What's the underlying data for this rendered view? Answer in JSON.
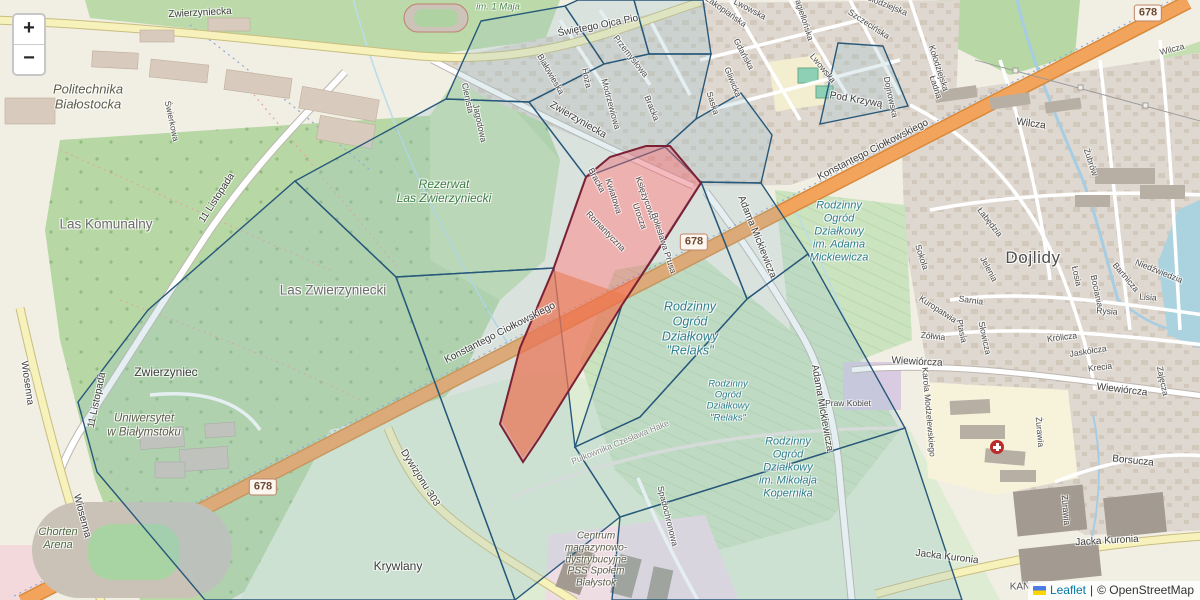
{
  "map": {
    "zoom_control": {
      "zoom_in": "+",
      "zoom_out": "−"
    },
    "attribution": {
      "flag_icon": "ukraine-flag-icon",
      "leaflet_label": "Leaflet",
      "separator": "|",
      "osm_label": "© OpenStreetMap"
    },
    "colors": {
      "overlay_stroke": "#27587a",
      "overlay_fill": "rgba(150,190,205,0.25)",
      "highlight_stroke": "#7a2136",
      "highlight_fill": "rgba(233,102,113,0.45)",
      "highlight_overlap_fill": "rgba(233,140,50,0.55)",
      "main_road": "#f2a35c",
      "leaflet_link": "#0078a8"
    },
    "road_badges": [
      {
        "text": "678",
        "x": 263,
        "y": 487
      },
      {
        "text": "678",
        "x": 694,
        "y": 242
      },
      {
        "text": "678",
        "x": 1148,
        "y": 13
      }
    ],
    "labels": [
      {
        "t": "Zwierzyniecka",
        "x": 200,
        "y": 13,
        "r": -3,
        "c": "road"
      },
      {
        "t": "Świętego Ojca Pio",
        "x": 598,
        "y": 26,
        "r": -11,
        "c": "road"
      },
      {
        "t": "Zwierzyniecka",
        "x": 578,
        "y": 120,
        "r": 30,
        "c": "road"
      },
      {
        "t": "Konstantego Ciołkowskiego",
        "x": 500,
        "y": 333,
        "r": -27,
        "c": "road"
      },
      {
        "t": "Konstantego Ciołkowskiego",
        "x": 873,
        "y": 150,
        "r": -27,
        "c": "road"
      },
      {
        "t": "11 Listopada",
        "x": 217,
        "y": 198,
        "r": -57,
        "c": "road"
      },
      {
        "t": "11 Listopada",
        "x": 97,
        "y": 400,
        "r": -78,
        "c": "road"
      },
      {
        "t": "Wiosenna",
        "x": 27,
        "y": 383,
        "r": 82,
        "c": "road"
      },
      {
        "t": "Wiosenna",
        "x": 82,
        "y": 516,
        "r": 75,
        "c": "road"
      },
      {
        "t": "Dywizjonu 303",
        "x": 420,
        "y": 478,
        "r": 58,
        "c": "road"
      },
      {
        "t": "Jacka Kuronia",
        "x": 947,
        "y": 557,
        "r": 7,
        "c": "road"
      },
      {
        "t": "Jacka Kuronia",
        "x": 1107,
        "y": 541,
        "r": -3,
        "c": "road"
      },
      {
        "t": "Adama Mickiewicza",
        "x": 757,
        "y": 237,
        "r": 68,
        "c": "road"
      },
      {
        "t": "Adama Mickiewicza",
        "x": 822,
        "y": 408,
        "r": 80,
        "c": "road"
      },
      {
        "t": "Pułkownika Czesława Hake",
        "x": 620,
        "y": 442,
        "r": -22,
        "c": "road-faint"
      },
      {
        "t": "Spadochronowa",
        "x": 668,
        "y": 516,
        "r": 76,
        "c": "road-sm"
      },
      {
        "t": "Wiewiórcza",
        "x": 917,
        "y": 362,
        "r": 3,
        "c": "road"
      },
      {
        "t": "Wiewiórcza",
        "x": 1122,
        "y": 390,
        "r": 7,
        "c": "road"
      },
      {
        "t": "Karola Modzelewskiego",
        "x": 929,
        "y": 412,
        "r": 85,
        "c": "road-sm"
      },
      {
        "t": "Praw Kobiet",
        "x": 848,
        "y": 403,
        "r": 0,
        "c": "road-sm"
      },
      {
        "t": "Borsucza",
        "x": 1133,
        "y": 461,
        "r": 6,
        "c": "road"
      },
      {
        "t": "Żurawia",
        "x": 1040,
        "y": 432,
        "r": 85,
        "c": "road-sm"
      },
      {
        "t": "Żurawia",
        "x": 1066,
        "y": 510,
        "r": 85,
        "c": "road-sm"
      },
      {
        "t": "Wilcza",
        "x": 1031,
        "y": 124,
        "r": 8,
        "c": "road"
      },
      {
        "t": "Wilcza",
        "x": 1172,
        "y": 49,
        "r": -15,
        "c": "road-sm"
      },
      {
        "t": "Białowieska",
        "x": 551,
        "y": 74,
        "r": 60,
        "c": "road-sm"
      },
      {
        "t": "Hoża",
        "x": 587,
        "y": 78,
        "r": 78,
        "c": "road-sm"
      },
      {
        "t": "Przemysłowa",
        "x": 631,
        "y": 56,
        "r": 52,
        "c": "road-sm"
      },
      {
        "t": "Modrzewiowa",
        "x": 611,
        "y": 104,
        "r": 75,
        "c": "road-sm"
      },
      {
        "t": "Bracka",
        "x": 652,
        "y": 108,
        "r": 68,
        "c": "road-sm"
      },
      {
        "t": "Bracka",
        "x": 597,
        "y": 180,
        "r": 62,
        "c": "road-sm"
      },
      {
        "t": "Saska",
        "x": 713,
        "y": 103,
        "r": 72,
        "c": "road-sm"
      },
      {
        "t": "Gliwicka",
        "x": 733,
        "y": 82,
        "r": 68,
        "c": "road-sm"
      },
      {
        "t": "Gdańska",
        "x": 744,
        "y": 54,
        "r": 62,
        "c": "road-sm"
      },
      {
        "t": "Zakopiańska",
        "x": 726,
        "y": 11,
        "r": 35,
        "c": "road-sm"
      },
      {
        "t": "Lwowska",
        "x": 750,
        "y": 9,
        "r": 28,
        "c": "road-sm"
      },
      {
        "t": "Lwowska",
        "x": 823,
        "y": 68,
        "r": 50,
        "c": "road-sm"
      },
      {
        "t": "Jagiellońska",
        "x": 804,
        "y": 18,
        "r": 72,
        "c": "road-sm"
      },
      {
        "t": "Szczecińska",
        "x": 869,
        "y": 24,
        "r": 33,
        "c": "road-sm"
      },
      {
        "t": "Kołodziejska",
        "x": 885,
        "y": 4,
        "r": 22,
        "c": "road-sm"
      },
      {
        "t": "Kołodziejska",
        "x": 939,
        "y": 68,
        "r": 72,
        "c": "road-sm"
      },
      {
        "t": "Pod Krzywą",
        "x": 856,
        "y": 100,
        "r": 10,
        "c": "road"
      },
      {
        "t": "Ładna",
        "x": 936,
        "y": 87,
        "r": 72,
        "c": "road-sm"
      },
      {
        "t": "Dojnowska",
        "x": 891,
        "y": 97,
        "r": 78,
        "c": "road-sm"
      },
      {
        "t": "Sokola",
        "x": 922,
        "y": 257,
        "r": 72,
        "c": "road-sm"
      },
      {
        "t": "Łabędzia",
        "x": 990,
        "y": 222,
        "r": 52,
        "c": "road-sm"
      },
      {
        "t": "Jelenia",
        "x": 989,
        "y": 269,
        "r": 62,
        "c": "road-sm"
      },
      {
        "t": "Sarnia",
        "x": 971,
        "y": 300,
        "r": 8,
        "c": "road-sm"
      },
      {
        "t": "Kuropatwia",
        "x": 938,
        "y": 309,
        "r": 33,
        "c": "road-sm"
      },
      {
        "t": "Żółwia",
        "x": 933,
        "y": 336,
        "r": 6,
        "c": "road-sm"
      },
      {
        "t": "Ptasia",
        "x": 962,
        "y": 331,
        "r": 78,
        "c": "road-sm"
      },
      {
        "t": "Słowicza",
        "x": 985,
        "y": 338,
        "r": 78,
        "c": "road-sm"
      },
      {
        "t": "Królicza",
        "x": 1062,
        "y": 337,
        "r": -7,
        "c": "road-sm"
      },
      {
        "t": "Jaskółcza",
        "x": 1088,
        "y": 351,
        "r": -9,
        "c": "road-sm"
      },
      {
        "t": "Krecia",
        "x": 1100,
        "y": 367,
        "r": -7,
        "c": "road-sm"
      },
      {
        "t": "Zajęcza",
        "x": 1163,
        "y": 381,
        "r": 78,
        "c": "road-sm"
      },
      {
        "t": "Niedźwiedzia",
        "x": 1159,
        "y": 271,
        "r": 22,
        "c": "road-sm"
      },
      {
        "t": "Bartnicza",
        "x": 1126,
        "y": 277,
        "r": 50,
        "c": "road-sm"
      },
      {
        "t": "Łosia",
        "x": 1077,
        "y": 276,
        "r": 78,
        "c": "road-sm"
      },
      {
        "t": "Bociania",
        "x": 1097,
        "y": 291,
        "r": 78,
        "c": "road-sm"
      },
      {
        "t": "Żubrów",
        "x": 1091,
        "y": 162,
        "r": 72,
        "c": "road-sm"
      },
      {
        "t": "Jagodowa",
        "x": 480,
        "y": 123,
        "r": 78,
        "c": "road-sm"
      },
      {
        "t": "Cienista",
        "x": 468,
        "y": 98,
        "r": 78,
        "c": "road-sm"
      },
      {
        "t": "Świerkowa",
        "x": 172,
        "y": 121,
        "r": 78,
        "c": "road-sm"
      },
      {
        "t": "Lisia",
        "x": 1148,
        "y": 297,
        "r": 4,
        "c": "road-sm"
      },
      {
        "t": "Rysia",
        "x": 1107,
        "y": 311,
        "r": 4,
        "c": "road-sm"
      },
      {
        "t": "Pawia",
        "x": 1023,
        "y": 257,
        "r": 8,
        "c": "road-sm"
      },
      {
        "t": "Romantyczna",
        "x": 606,
        "y": 231,
        "r": 46,
        "c": "road-sm"
      },
      {
        "t": "Kwiatowa",
        "x": 614,
        "y": 196,
        "r": 72,
        "c": "road-sm"
      },
      {
        "t": "Księżycowa",
        "x": 646,
        "y": 198,
        "r": 70,
        "c": "road-sm"
      },
      {
        "t": "Urocza",
        "x": 640,
        "y": 216,
        "r": 70,
        "c": "road-sm"
      },
      {
        "t": "Bolesława Prusa",
        "x": 664,
        "y": 243,
        "r": 72,
        "c": "road-sm"
      },
      {
        "t": "Las Zwierzyniecki",
        "x": 333,
        "y": 290,
        "r": 0,
        "c": "place-lg"
      },
      {
        "t": "Las Komunalny",
        "x": 106,
        "y": 224,
        "r": 0,
        "c": "place-lg"
      },
      {
        "t": "Zwierzyniec",
        "x": 166,
        "y": 372,
        "r": 0,
        "c": "place"
      },
      {
        "t": "Krywlany",
        "x": 398,
        "y": 566,
        "r": 0,
        "c": "place"
      },
      {
        "t": "Dojlidy",
        "x": 1033,
        "y": 258,
        "r": 0,
        "c": "district"
      },
      {
        "t": "im. 1 Maja",
        "x": 498,
        "y": 7,
        "r": 0,
        "c": "nature-sm"
      },
      {
        "t": "KAN",
        "x": 1020,
        "y": 587,
        "r": 0,
        "c": "place-sm"
      }
    ],
    "multiline_labels": [
      {
        "lines": [
          "Politechnika",
          "Białostocka"
        ],
        "x": 88,
        "y": 97,
        "c": "poi",
        "s": 13
      },
      {
        "lines": [
          "Rezerwat",
          "Las Zwierzyniecki"
        ],
        "x": 444,
        "y": 191,
        "c": "nature",
        "s": 12
      },
      {
        "lines": [
          "Uniwersytet",
          "w Białymstoku"
        ],
        "x": 144,
        "y": 426,
        "c": "poi",
        "s": 11.5
      },
      {
        "lines": [
          "Chorten",
          "Arena"
        ],
        "x": 58,
        "y": 539,
        "c": "poi-green",
        "s": 11
      },
      {
        "lines": [
          "Centrum",
          "magazynowo-",
          "dystrybucyjne",
          "PSS Społem",
          "Białystok"
        ],
        "x": 596,
        "y": 560,
        "c": "poi",
        "s": 10
      },
      {
        "lines": [
          "Rodzinny",
          "Ogród",
          "Działkowy",
          "im. Adama",
          "Mickiewicza"
        ],
        "x": 839,
        "y": 232,
        "c": "garden",
        "s": 11
      },
      {
        "lines": [
          "Rodzinny",
          "Ogród",
          "Działkowy",
          "\"Relaks\""
        ],
        "x": 690,
        "y": 329,
        "c": "garden-lg",
        "s": 12.5
      },
      {
        "lines": [
          "Rodzinny",
          "Ogród",
          "Działkowy",
          "\"Relaks\""
        ],
        "x": 728,
        "y": 401,
        "c": "garden-sm",
        "s": 9.5
      },
      {
        "lines": [
          "Rodzinny",
          "Ogród",
          "Działkowy",
          "im. Mikołaja",
          "Kopernika"
        ],
        "x": 788,
        "y": 468,
        "c": "garden",
        "s": 11
      }
    ],
    "overlay": {
      "cells": [
        "481,21 565,6 604,64 529,102 446,99",
        "565,6 578,0 634,0 649,54 604,64",
        "634,0 703,0 711,54 649,54",
        "604,64 649,54 711,54 696,119 665,147 586,177 529,102",
        "696,119 741,93 772,135 761,183 701,182 665,147",
        "761,183 808,254 747,299 701,182",
        "838,43 883,46 908,106 820,124",
        "446,99 529,102 586,177 554,268 396,277 295,181",
        "295,181 396,277 515,600 205,600 97,472 78,402 148,310",
        "396,277 554,268 575,447 620,517 515,600",
        "620,517 905,428 962,600 612,600",
        "701,182 747,299 640,417 575,447 622,305",
        "747,299 808,254 905,428 620,517 575,447 640,417"
      ],
      "highlight_cell": "586,177 610,157 646,146 670,146 701,183 655,255 622,305 540,437 523,462 500,424 520,348 553,270",
      "highlight_overlap": "553,270 628,296 545,428 523,458 502,422 520,350"
    },
    "poi_icons": [
      {
        "name": "hospital-icon",
        "x": 997,
        "y": 447
      }
    ]
  }
}
